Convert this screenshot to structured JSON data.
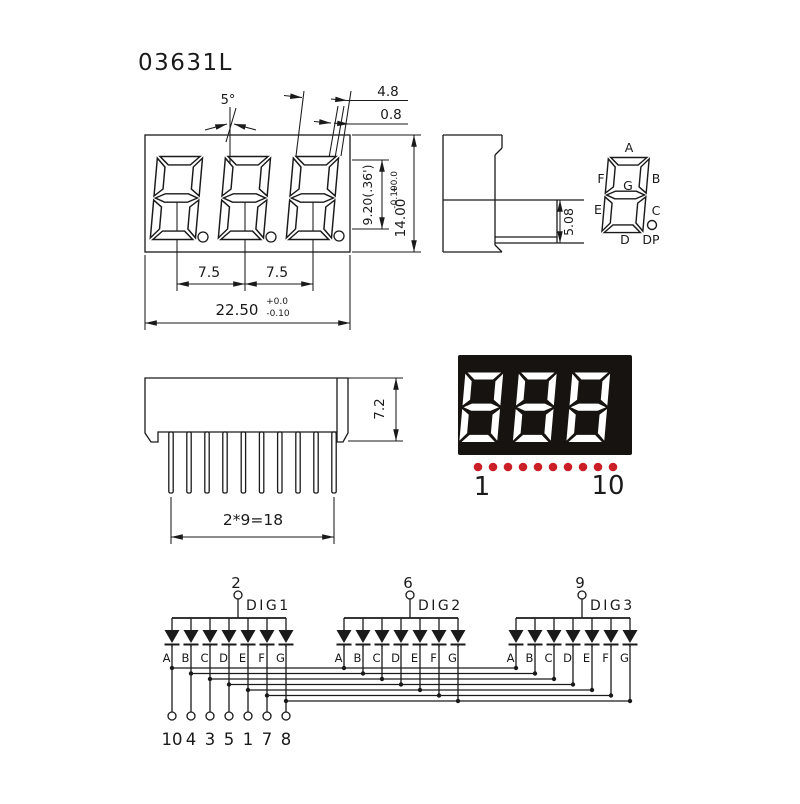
{
  "part_number": "03631L",
  "front_view": {
    "angle_label": "5°",
    "dim_seg_width": "4.8",
    "dim_seg_gap": "0.8",
    "dim_digit_height": "9.20(.36')",
    "dim_height": "14.00",
    "dim_height_tol_plus": "+0.0",
    "dim_height_tol_minus": "-0.10",
    "dim_pitch_left": "7.5",
    "dim_pitch_right": "7.5",
    "dim_width": "22.50",
    "dim_width_tol_plus": "+0.0",
    "dim_width_tol_minus": "-0.10"
  },
  "side_view": {
    "dim_depth": "5.08"
  },
  "segment_map": {
    "a": "A",
    "b": "B",
    "c": "C",
    "d": "D",
    "e": "E",
    "f": "F",
    "g": "G",
    "dp": "DP"
  },
  "bottom_view": {
    "dim_height": "7.2",
    "dim_pin_span": "2*9=18"
  },
  "photo": {
    "digits_shown": "888",
    "pin_start_label": "1",
    "pin_end_label": "10",
    "dot_count": 10,
    "body_color": "#171310",
    "segment_color": "#ffffff",
    "dot_color": "#cb1f27"
  },
  "schematic": {
    "digits": [
      {
        "pin": "2",
        "label": "DIG1",
        "segments": [
          "A",
          "B",
          "C",
          "D",
          "E",
          "F",
          "G"
        ]
      },
      {
        "pin": "6",
        "label": "DIG2",
        "segments": [
          "A",
          "B",
          "C",
          "D",
          "E",
          "F",
          "G"
        ]
      },
      {
        "pin": "9",
        "label": "DIG3",
        "segments": [
          "A",
          "B",
          "C",
          "D",
          "E",
          "F",
          "G"
        ]
      }
    ],
    "bottom_pins": [
      "10",
      "4",
      "3",
      "5",
      "1",
      "7",
      "8"
    ]
  }
}
